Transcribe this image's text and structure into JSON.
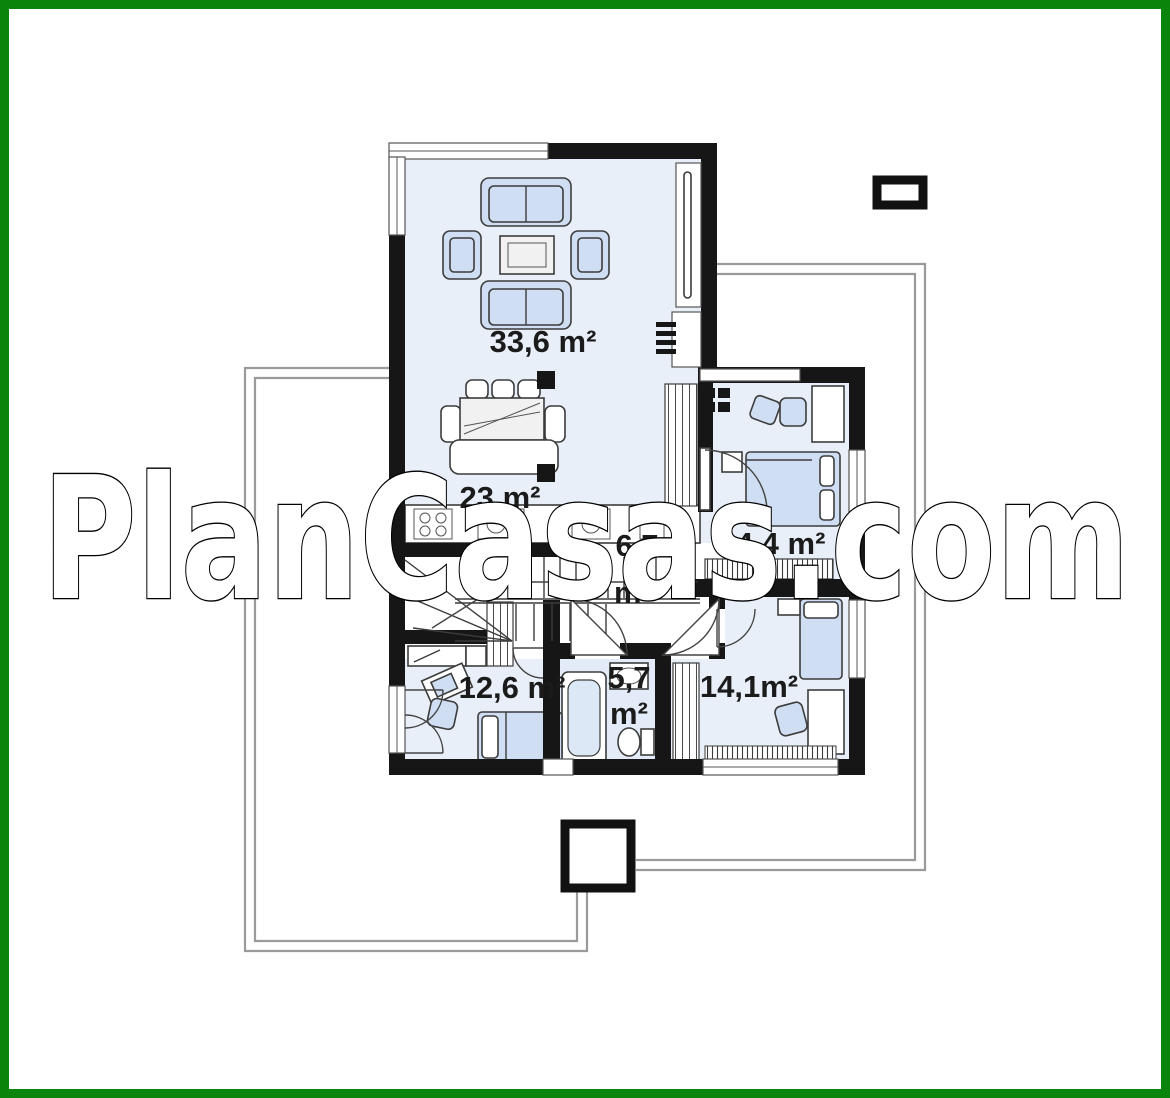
{
  "watermark": {
    "text": "PlanCasas.com"
  },
  "floor_plan": {
    "rooms": [
      {
        "name": "living-room",
        "area": "33,6 m²"
      },
      {
        "name": "dining-area",
        "area": "23 m²"
      },
      {
        "name": "hallway",
        "area_value": "6,7",
        "area_unit": "m²"
      },
      {
        "name": "bedroom-top-right",
        "area": "14,4 m²"
      },
      {
        "name": "bedroom-bottom-left",
        "area": "12,6 m²"
      },
      {
        "name": "bathroom",
        "area_value": "5,7",
        "area_unit": "m²"
      },
      {
        "name": "bedroom-bottom-right",
        "area": "14,1m²"
      }
    ],
    "colors": {
      "frame_green": "#0a840a",
      "wall": "#161616",
      "room_fill": "#e9eff8",
      "furniture_fill": "#cfdef2",
      "terrace_outline": "#9a9a9a"
    }
  }
}
